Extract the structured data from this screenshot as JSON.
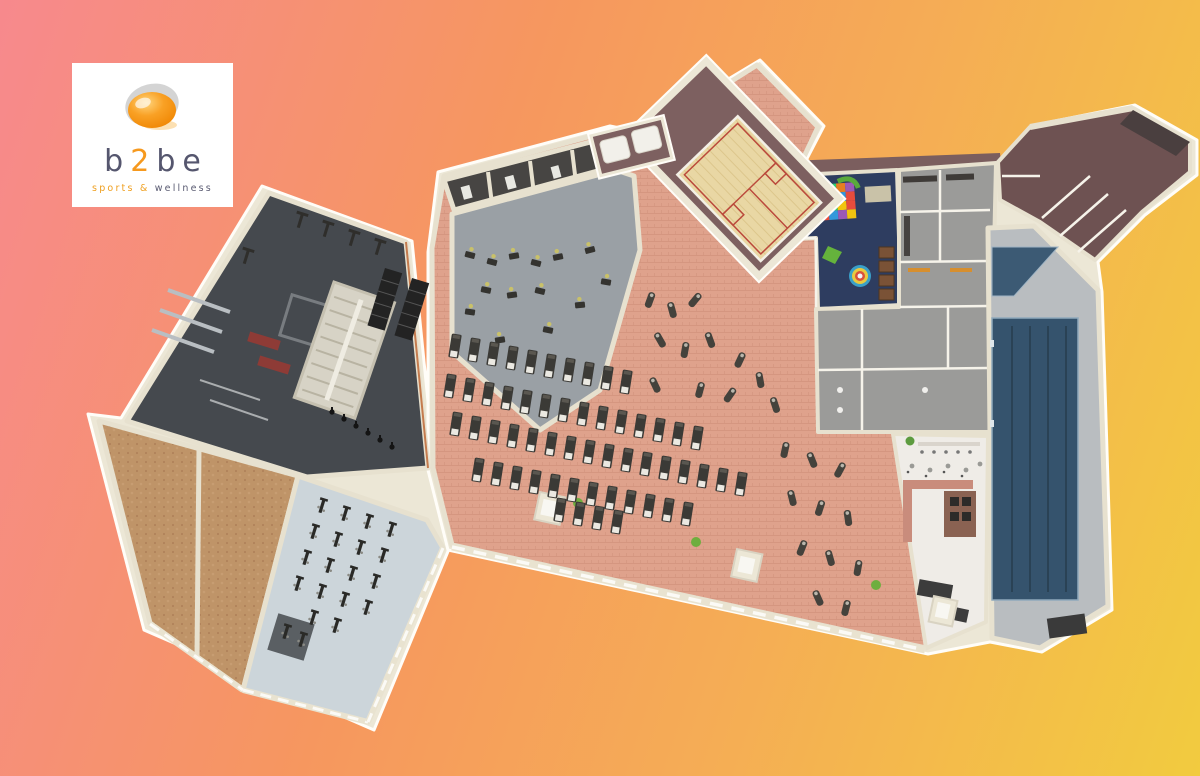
{
  "logo": {
    "brand": {
      "prefix": "b",
      "accent": "2",
      "suffix": "be"
    },
    "tagline": {
      "accent": "sports &",
      "rest": "wellness"
    }
  },
  "palette": {
    "background_start": "#f7898d",
    "background_mid": "#f5ad55",
    "background_end": "#f2cb3f",
    "logo_orange": "#f6991e",
    "logo_text": "#55566e",
    "wall_cream": "#ece7d6",
    "wall_highlight": "#fffdf8"
  },
  "floorplan": {
    "zones": {
      "weights_room": "#45494e",
      "studio_wood": "#bf9468",
      "spinning_studio": "#ccd5da",
      "cardio_hall": "#dfa28c",
      "machines_area": "#9aa0a5",
      "treatment_rooms": "#474543",
      "squash_gallery": "#7d6060",
      "squash_court": "#e9d7a4",
      "sunbed_room": "#7d6060",
      "kids_club": "#2e3d60",
      "changing_rooms": "#9b9b99",
      "corridor": "#7b5e5e",
      "offices_wing": "#6e5252",
      "pool_deck": "#b9bdc0",
      "pool_water": "#35536d",
      "whirlpool": "#3c5a74",
      "cafe": "#efece7",
      "stairs": "#d7d3c6"
    }
  }
}
